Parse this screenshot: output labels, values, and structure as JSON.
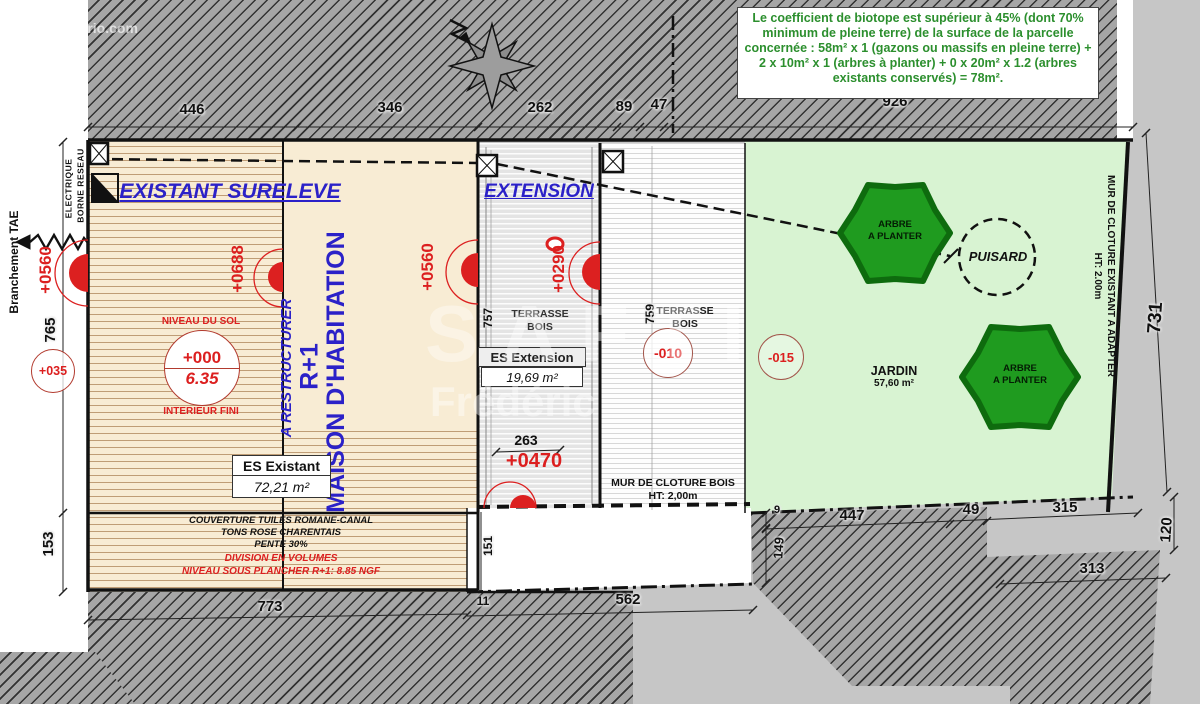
{
  "watermarks": {
    "top_left": "© EtreProprio.com",
    "brand": "SAFTI",
    "name": "Frédéric"
  },
  "note": {
    "biotope": "Le coefficient de biotope est supérieur à 45% (dont 70% minimum de pleine terre) de la surface de la parcelle concernée : 58m² x 1 (gazons ou massifs en pleine terre) + 2 x 10m² x 1 (arbres à planter) + 0 x 20m² x 1.2 (arbres existants conservés) = 78m²."
  },
  "zones": {
    "existant": "EXISTANT SURELEVE",
    "extension": "EXTENSION",
    "maison_line1": "MAISON D'HABITATION",
    "maison_line2": "R+1",
    "a_restructurer": "A RESTRUCTURER",
    "terrasse_line1": "TERRASSE",
    "terrasse_line2": "BOIS",
    "jardin": "JARDIN",
    "jardin_area": "57,60 m²",
    "puisard": "PUISARD",
    "arbre_line1": "ARBRE",
    "arbre_line2": "A PLANTER"
  },
  "levels": {
    "plus0560": "+0560",
    "plus0688": "+0688",
    "plus0560b": "+0560",
    "plus0290": "+0290",
    "plus0470": "+0470",
    "plus035": "+035",
    "plus000": "+000",
    "ngf": "6.35",
    "minus010": "-010",
    "minus015": "-015",
    "niveau_du_sol": "NIVEAU DU SOL",
    "interieur_fini": "INTERIEUR FINI"
  },
  "surfaces": {
    "es_existant": "ES Existant",
    "es_existant_area": "72,21 m²",
    "es_extension": "ES Extension",
    "es_extension_area": "19,69 m²"
  },
  "walls": {
    "mur_bois": "MUR DE CLOTURE BOIS",
    "mur_bois_ht": "HT: 2,00m",
    "mur_existant": "MUR DE CLOTURE EXISTANT A ADAPTER",
    "mur_existant_ht": "HT: 2.00m"
  },
  "roof": {
    "l1": "COUVERTURE TUILES ROMANE-CANAL",
    "l2": "TONS ROSE CHARENTAIS",
    "l3": "PENTE 30%",
    "l4": "DIVISION EN VOLUMES",
    "l5": "NIVEAU SOUS PLANCHER R+1: 8.85 NGF"
  },
  "utilities": {
    "branchement": "Branchement TAE",
    "borne_l1": "BORNE RESEAU",
    "borne_l2": "ELECTRIQUE"
  },
  "dims": {
    "d446": "446",
    "d346": "346",
    "d262": "262",
    "d89": "89",
    "d47": "47",
    "d926": "926",
    "d765": "765",
    "d153": "153",
    "d773": "773",
    "d11": "11",
    "d562": "562",
    "d731": "731",
    "d120": "120",
    "d757": "757",
    "d759": "759",
    "d151": "151",
    "d263": "263",
    "d9": "9",
    "d149": "149",
    "d447": "447",
    "d49": "49",
    "d315": "315",
    "d313": "313"
  },
  "colors": {
    "blue_text": "#2b21c8",
    "red_text": "#dc1f1f",
    "note_green": "#2c8f2e",
    "tree_green": "#1f9b1f",
    "garden_green": "#d8f3d2",
    "beige": "#f8ecd4"
  }
}
